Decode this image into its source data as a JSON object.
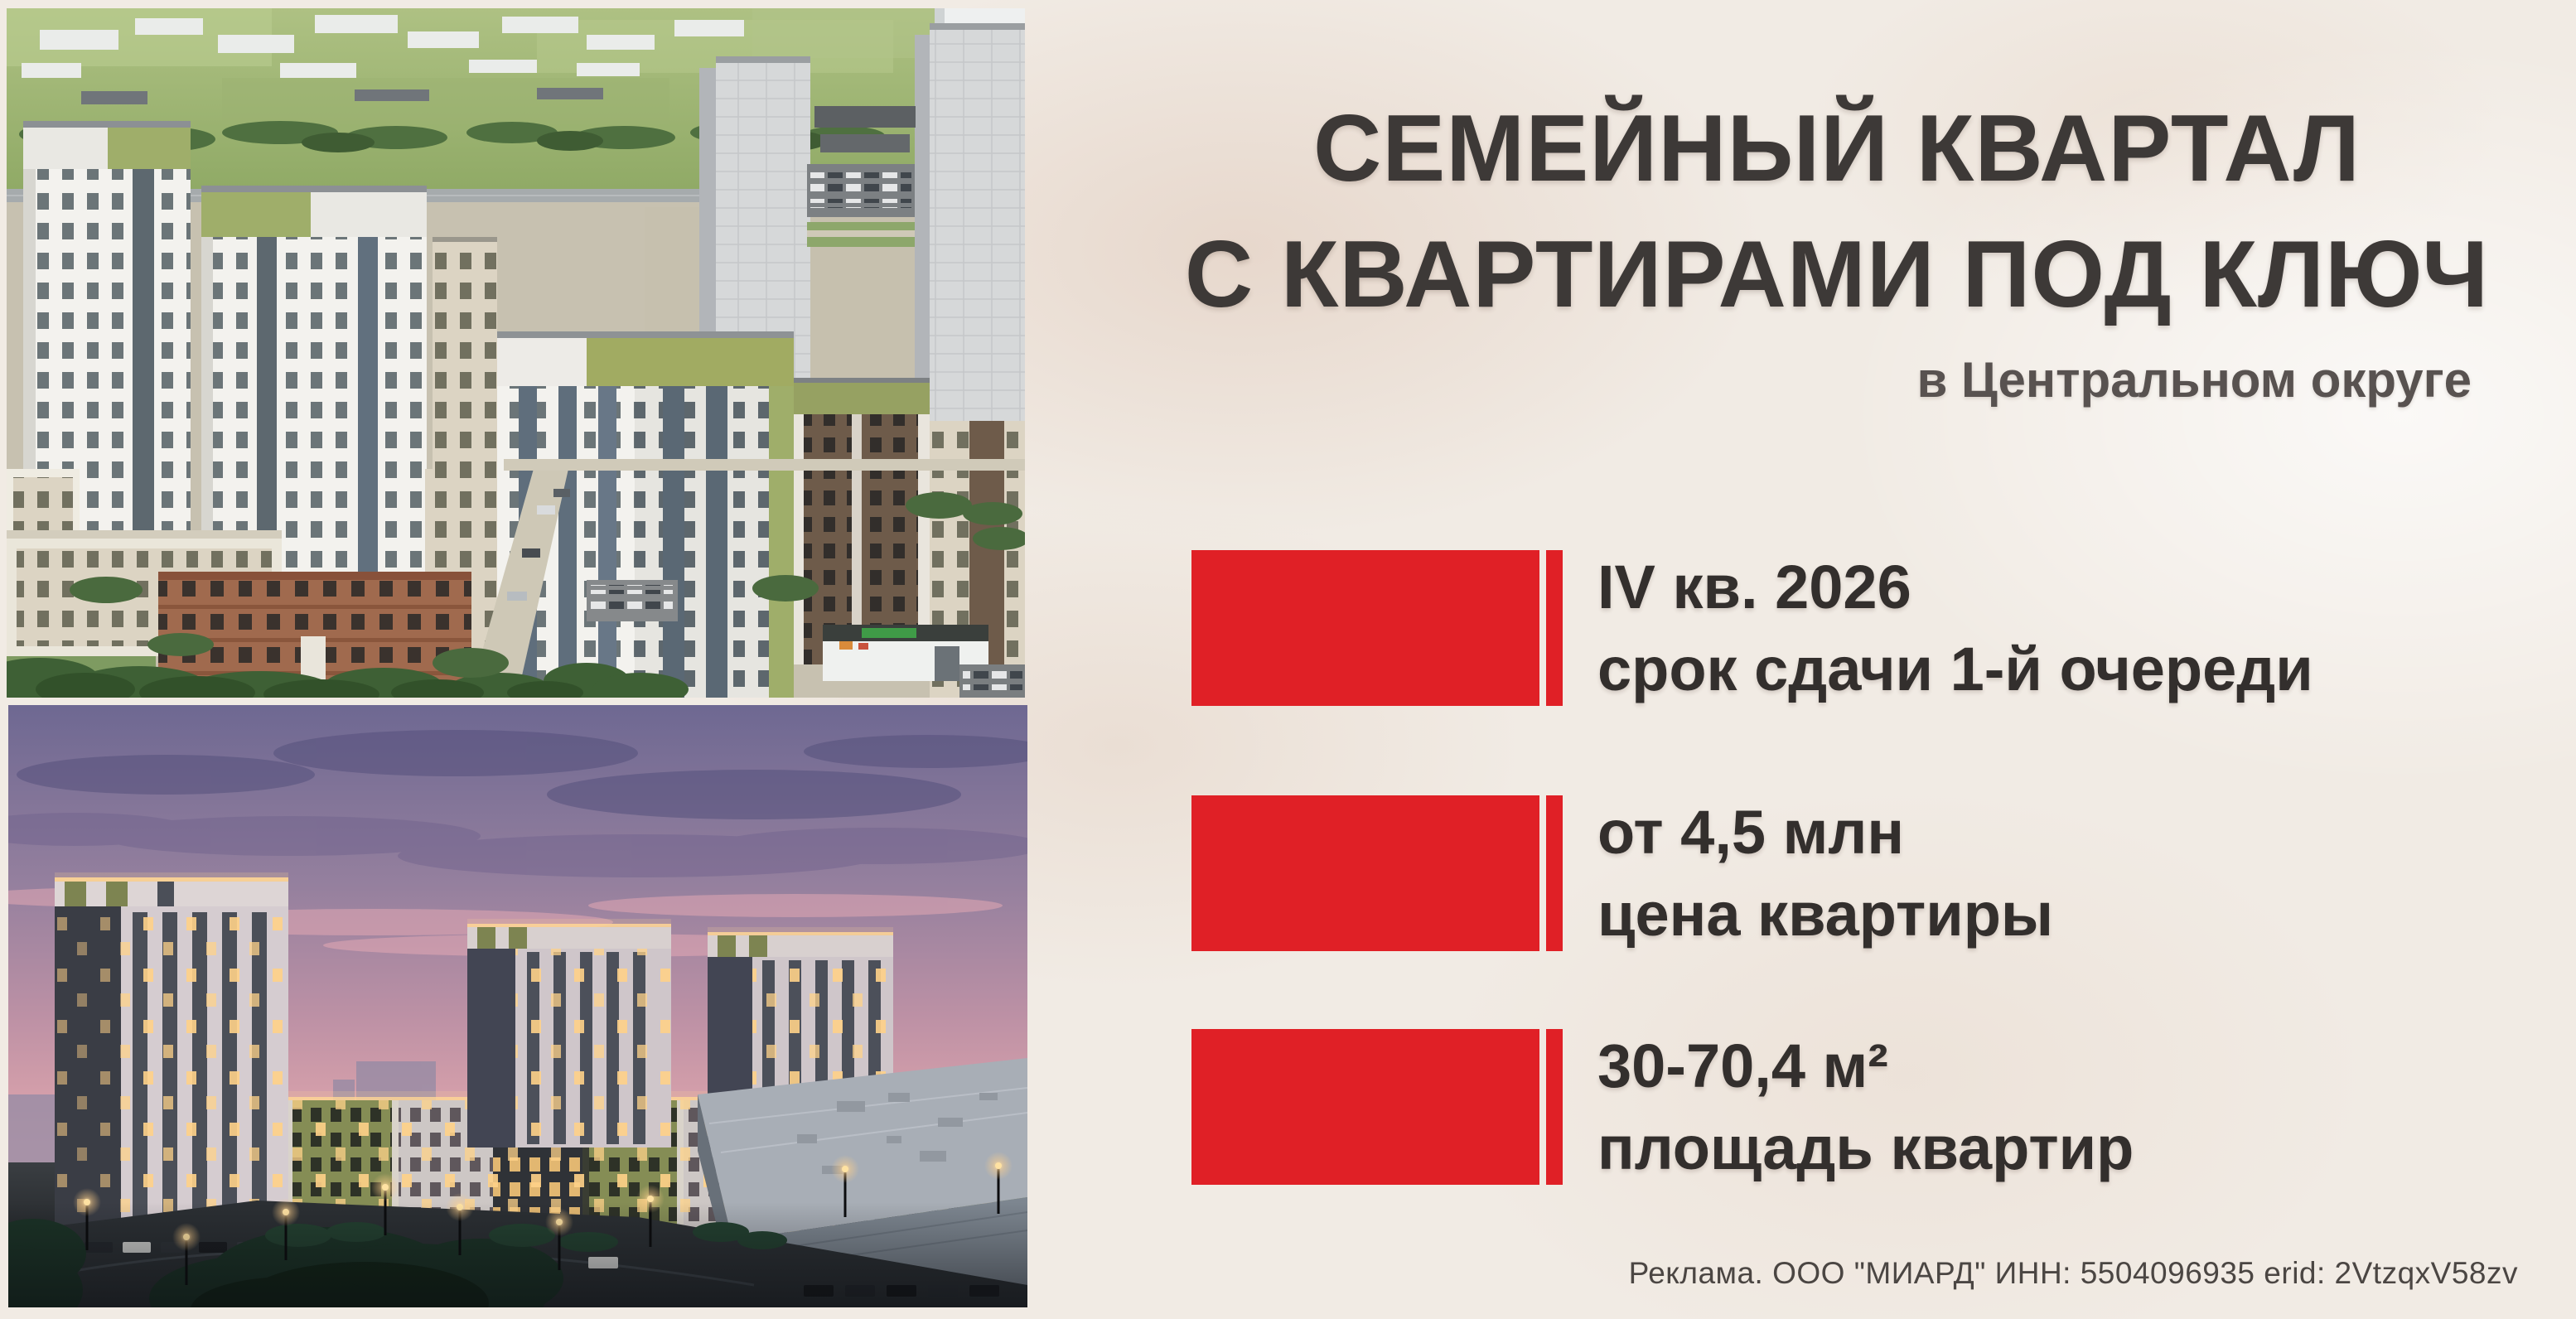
{
  "panel": {
    "headline_line1": "СЕМЕЙНЫЙ КВАРТАЛ",
    "headline_line2": "С КВАРТИРАМИ ПОД КЛЮЧ",
    "location": "в Центральном округе",
    "stats": [
      {
        "value": "IV кв. 2026",
        "label": "срок сдачи 1-й очереди"
      },
      {
        "value": "от 4,5 млн",
        "label": "цена квартиры"
      },
      {
        "value": "30-70,4 м²",
        "label": "площадь квартир"
      }
    ],
    "disclaimer": "Реклама. ООО \"МИАРД\" ИНН: 5504096935 erid: 2VtzqxV58zv"
  },
  "photos": {
    "top_alt": "Дневной вид жилого квартала с высоты птичьего полёта",
    "bottom_alt": "Вечерний вид жилого квартала с подсветкой"
  },
  "colors": {
    "accent_red": "#E02026",
    "background": "#F1EBE4",
    "headline": "#3D3937",
    "location": "#585250",
    "stat_text": "#332F2D",
    "disclaimer": "#4B4643"
  }
}
